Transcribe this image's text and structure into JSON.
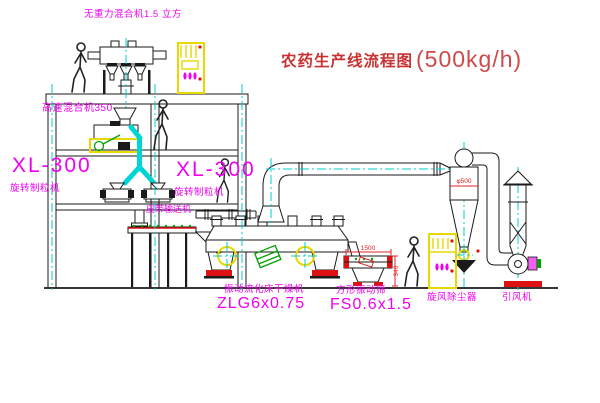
{
  "title": {
    "text": "农药生产线流程图",
    "capacity": "(500kg/h)"
  },
  "equipment_labels": {
    "gravity_mixer": "无重力混合机1.5 立方",
    "high_speed_mixer": "高速混合机350",
    "granulator_left": {
      "model": "XL-300",
      "name": "旋转制粒机"
    },
    "granulator_right": {
      "model": "XL-300",
      "name": "旋转制粒机"
    },
    "belt_conveyor": "皮带输送机",
    "fluid_bed_dryer": {
      "name": "振动流化床干燥机",
      "model": "ZLG6x0.75"
    },
    "square_sieve": {
      "name": "方形振动筛",
      "model": "FS0.6x1.5"
    },
    "cyclone": "旋风除尘器",
    "induced_draft_fan": "引风机"
  },
  "dimensions": {
    "sieve_length": "1500",
    "sieve_height": "340",
    "cyclone_diameter": "φ500"
  },
  "colors": {
    "line": "#1a1a1a",
    "centerline": "#00cccc",
    "label_magenta": "#f000f0",
    "title_red": "#c83232",
    "dimension_red": "#e02020",
    "cabinet_yellow": "#e8d800",
    "motor_green": "#00a000",
    "base_red": "#dd1111"
  }
}
